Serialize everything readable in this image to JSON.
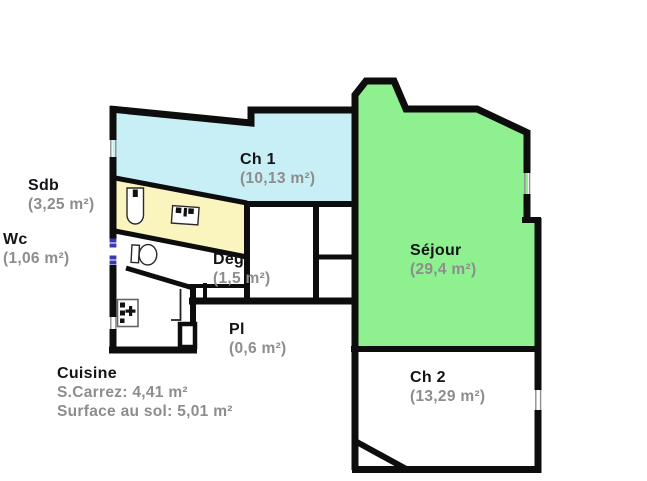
{
  "plan": {
    "title": "apartment-floor-plan",
    "rooms": {
      "sdb": {
        "name": "Sdb",
        "area": "(3,25 m²)"
      },
      "wc": {
        "name": "Wc",
        "area": "(1,06 m²)"
      },
      "ch1": {
        "name": "Ch 1",
        "area": "(10,13 m²)"
      },
      "sejour": {
        "name": "Séjour",
        "area": "(29,4 m²)"
      },
      "deg": {
        "name": "Dég",
        "area": "(1,5 m²)"
      },
      "pl": {
        "name": "Pl",
        "area": "(0,6 m²)"
      },
      "ch2": {
        "name": "Ch 2",
        "area": "(13,29 m²)"
      },
      "cuisine": {
        "name": "Cuisine",
        "carrez": "S.Carrez: 4,41 m²",
        "floor": "Surface au sol: 5,01 m²"
      }
    },
    "colors": {
      "ch1_fill": "#c8eef6",
      "sdb_fill": "#faf4bf",
      "sejour_fill": "#8ef08e",
      "wall": "#0d0d0d",
      "room_name_text": "#131318",
      "area_text": "#8d8d8d",
      "window_tick": "#3a3ab0"
    },
    "fixtures": [
      "bathtub",
      "washbasin",
      "toilet",
      "kitchen-sink"
    ]
  }
}
